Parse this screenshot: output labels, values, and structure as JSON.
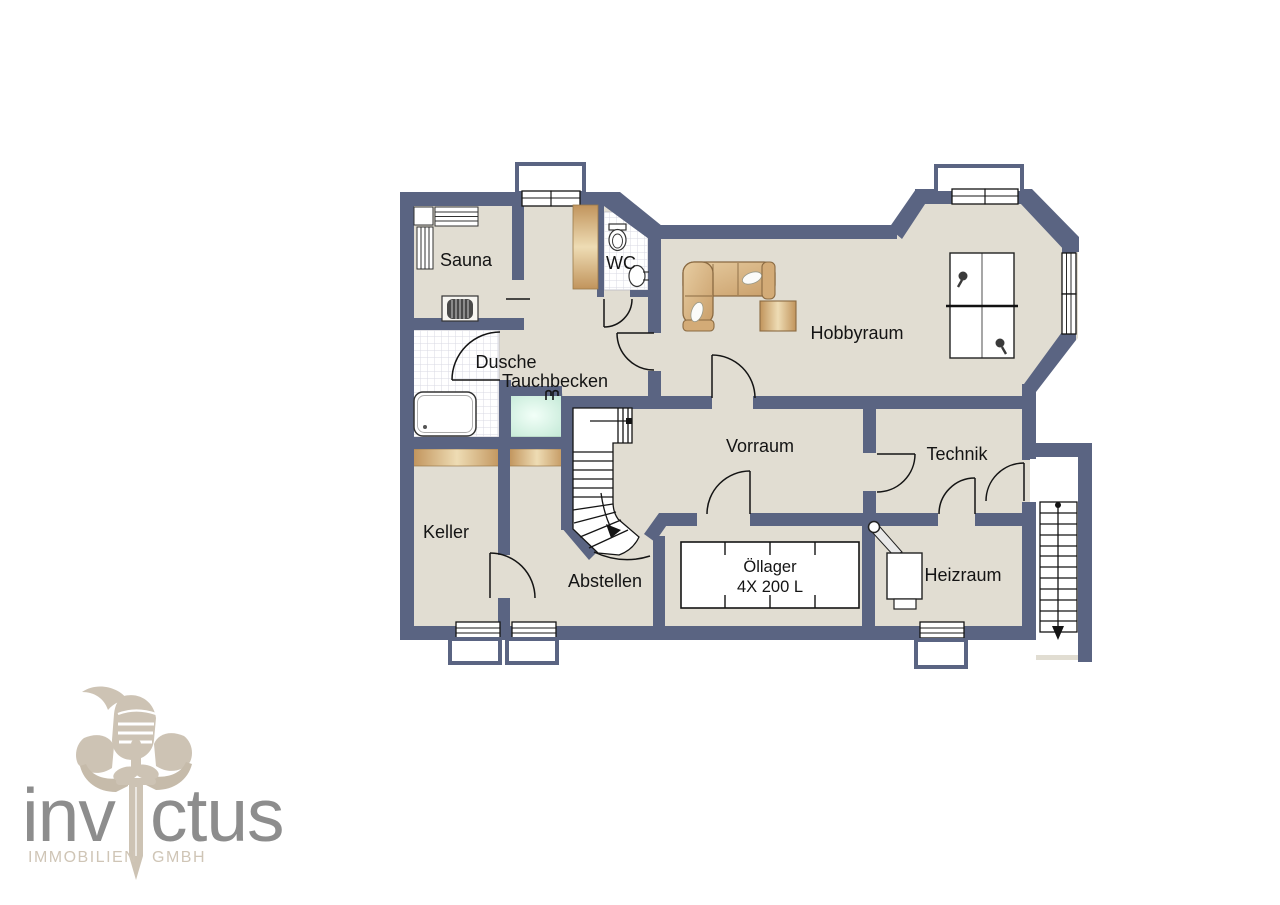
{
  "plan": {
    "title": "Kellergeschoss Grundriss",
    "rooms": [
      {
        "id": "sauna",
        "label": "Sauna"
      },
      {
        "id": "wc",
        "label": "WC"
      },
      {
        "id": "hobbyraum",
        "label": "Hobbyraum"
      },
      {
        "id": "dusche",
        "label": "Dusche"
      },
      {
        "id": "tauchbecken",
        "label": "Tauchbecken"
      },
      {
        "id": "vorraum",
        "label": "Vorraum"
      },
      {
        "id": "technik",
        "label": "Technik"
      },
      {
        "id": "keller",
        "label": "Keller"
      },
      {
        "id": "abstellen",
        "label": "Abstellen"
      },
      {
        "id": "heizraum",
        "label": "Heizraum"
      }
    ],
    "oil_storage": {
      "name": "Öllager",
      "capacity": "4X 200 L",
      "tanks": 4
    },
    "features": [
      "sauna-benches",
      "sauna-stove",
      "shower-tray",
      "plunge-pool-ladder",
      "toilet",
      "sink",
      "wardrobe",
      "corner-sofa",
      "coffee-table",
      "table-tennis-table",
      "winder-staircase",
      "exterior-staircase",
      "boiler",
      "chimney",
      "oil-tanks",
      "light-wells"
    ],
    "colors": {
      "wall": "#5a6482",
      "floor": "#e1ddd2",
      "wood": "#c89f63",
      "pool": "#d9f4e6",
      "line": "#141414"
    }
  },
  "logo": {
    "brand_full": "invictus",
    "brand_left": "inv",
    "brand_right": "ctus",
    "subtitle_left": "IMMOBILIEN",
    "subtitle_right": "GMBH",
    "colors": {
      "text": "#8d8d8d",
      "emblem": "#cdc3b4"
    }
  }
}
